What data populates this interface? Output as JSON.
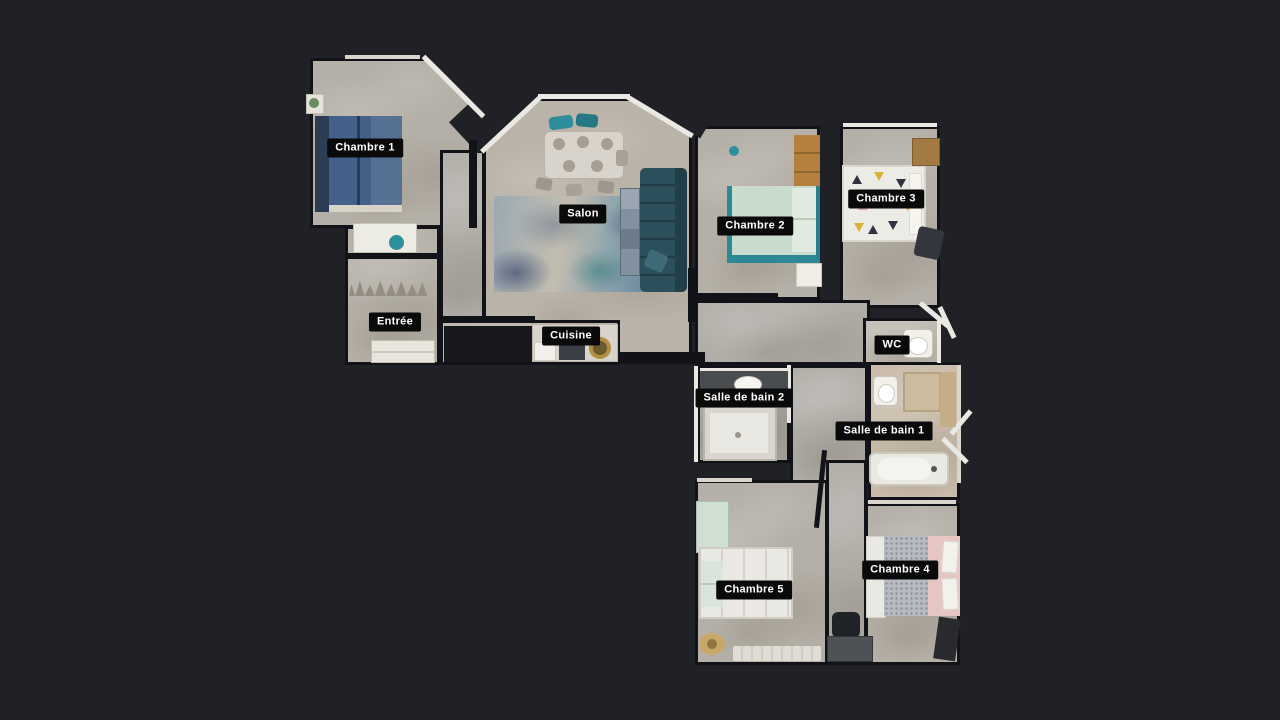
{
  "colors": {
    "background": "#1f2126",
    "label_background": "#0a0a0b",
    "label_text": "#ffffff",
    "floor_base": "#b5b0a7",
    "floor_warm": "#bab3a8",
    "floor_cool": "#b1aea8",
    "floor_beige": "#c9bcaa",
    "floor_light": "#c1bdb4",
    "wall_dark": "#111318",
    "wall_light": "#e9e8e3",
    "accent_bed_blue": "#44618a",
    "accent_sofa_teal": "#2b505c",
    "accent_bed_mint": "#c9dbcc",
    "accent_teal_frame": "#2c8894",
    "accent_wood": "#b5803e",
    "accent_bed_pink": "#e5c6c2"
  },
  "rooms": [
    {
      "id": "chambre-1",
      "label": "Chambre 1",
      "label_x": 365,
      "label_y": 148
    },
    {
      "id": "salon",
      "label": "Salon",
      "label_x": 583,
      "label_y": 214
    },
    {
      "id": "chambre-2",
      "label": "Chambre 2",
      "label_x": 755,
      "label_y": 226
    },
    {
      "id": "chambre-3",
      "label": "Chambre 3",
      "label_x": 886,
      "label_y": 199
    },
    {
      "id": "entree",
      "label": "Entrée",
      "label_x": 395,
      "label_y": 322
    },
    {
      "id": "cuisine",
      "label": "Cuisine",
      "label_x": 571,
      "label_y": 336
    },
    {
      "id": "wc",
      "label": "WC",
      "label_x": 892,
      "label_y": 345
    },
    {
      "id": "salle-de-bain-2",
      "label": "Salle de bain 2",
      "label_x": 744,
      "label_y": 398
    },
    {
      "id": "salle-de-bain-1",
      "label": "Salle de bain 1",
      "label_x": 884,
      "label_y": 431
    },
    {
      "id": "chambre-5",
      "label": "Chambre 5",
      "label_x": 754,
      "label_y": 590
    },
    {
      "id": "chambre-4",
      "label": "Chambre 4",
      "label_x": 900,
      "label_y": 570
    }
  ]
}
